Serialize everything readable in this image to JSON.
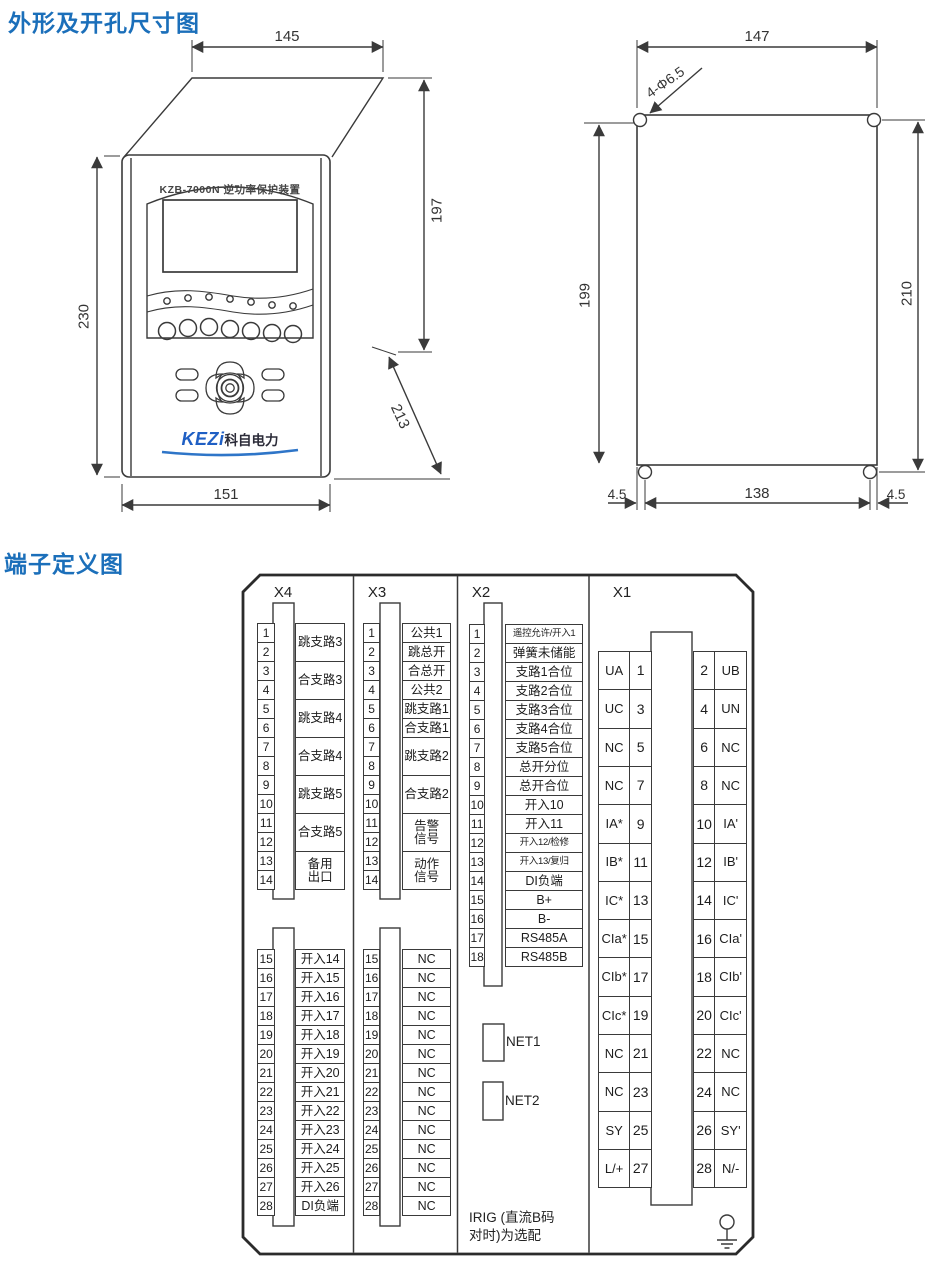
{
  "sections": {
    "outline_title": "外形及开孔尺寸图",
    "terminal_title": "端子定义图"
  },
  "front_view": {
    "device_title": "KZB-7000N 逆功率保护装置",
    "logo_main": "KEZi",
    "logo_sub": "科自电力",
    "dim_width_top": "145",
    "dim_height_rear": "197",
    "dim_height_front": "230",
    "dim_depth": "213",
    "dim_width_front": "151"
  },
  "cutout_view": {
    "dim_width_top": "147",
    "hole_label": "4-Φ6.5",
    "dim_height_left": "199",
    "dim_height_right": "210",
    "dim_margin_left": "4.5",
    "dim_hole_spacing": "138",
    "dim_margin_right": "4.5"
  },
  "terminal": {
    "x4": {
      "header": "X4",
      "top_first": 1,
      "top": [
        {
          "span": 2,
          "label": "跳支路3"
        },
        {
          "span": 2,
          "label": "合支路3"
        },
        {
          "span": 2,
          "label": "跳支路4"
        },
        {
          "span": 2,
          "label": "合支路4"
        },
        {
          "span": 2,
          "label": "跳支路5"
        },
        {
          "span": 2,
          "label": "合支路5"
        },
        {
          "span": 2,
          "label": "备用\n出口"
        }
      ],
      "bottom_first": 15,
      "bottom": [
        {
          "span": 1,
          "label": "开入14"
        },
        {
          "span": 1,
          "label": "开入15"
        },
        {
          "span": 1,
          "label": "开入16"
        },
        {
          "span": 1,
          "label": "开入17"
        },
        {
          "span": 1,
          "label": "开入18"
        },
        {
          "span": 1,
          "label": "开入19"
        },
        {
          "span": 1,
          "label": "开入20"
        },
        {
          "span": 1,
          "label": "开入21"
        },
        {
          "span": 1,
          "label": "开入22"
        },
        {
          "span": 1,
          "label": "开入23"
        },
        {
          "span": 1,
          "label": "开入24"
        },
        {
          "span": 1,
          "label": "开入25"
        },
        {
          "span": 1,
          "label": "开入26"
        },
        {
          "span": 1,
          "label": "DI负端"
        }
      ]
    },
    "x3": {
      "header": "X3",
      "top_first": 1,
      "top": [
        {
          "span": 1,
          "label": "公共1"
        },
        {
          "span": 1,
          "label": "跳总开"
        },
        {
          "span": 1,
          "label": "合总开"
        },
        {
          "span": 1,
          "label": "公共2"
        },
        {
          "span": 1,
          "label": "跳支路1"
        },
        {
          "span": 1,
          "label": "合支路1"
        },
        {
          "span": 2,
          "label": "跳支路2"
        },
        {
          "span": 2,
          "label": "合支路2"
        },
        {
          "span": 2,
          "label": "告警\n信号"
        },
        {
          "span": 2,
          "label": "动作\n信号"
        }
      ],
      "bottom_first": 15,
      "bottom": [
        {
          "span": 1,
          "label": "NC"
        },
        {
          "span": 1,
          "label": "NC"
        },
        {
          "span": 1,
          "label": "NC"
        },
        {
          "span": 1,
          "label": "NC"
        },
        {
          "span": 1,
          "label": "NC"
        },
        {
          "span": 1,
          "label": "NC"
        },
        {
          "span": 1,
          "label": "NC"
        },
        {
          "span": 1,
          "label": "NC"
        },
        {
          "span": 1,
          "label": "NC"
        },
        {
          "span": 1,
          "label": "NC"
        },
        {
          "span": 1,
          "label": "NC"
        },
        {
          "span": 1,
          "label": "NC"
        },
        {
          "span": 1,
          "label": "NC"
        },
        {
          "span": 1,
          "label": "NC"
        }
      ]
    },
    "x2": {
      "header": "X2",
      "top_first": 1,
      "top": [
        {
          "span": 1,
          "label": "遥控允许/开入1"
        },
        {
          "span": 1,
          "label": "弹簧未储能"
        },
        {
          "span": 1,
          "label": "支路1合位"
        },
        {
          "span": 1,
          "label": "支路2合位"
        },
        {
          "span": 1,
          "label": "支路3合位"
        },
        {
          "span": 1,
          "label": "支路4合位"
        },
        {
          "span": 1,
          "label": "支路5合位"
        },
        {
          "span": 1,
          "label": "总开分位"
        },
        {
          "span": 1,
          "label": "总开合位"
        },
        {
          "span": 1,
          "label": "开入10"
        },
        {
          "span": 1,
          "label": "开入11"
        },
        {
          "span": 1,
          "label": "开入12/检修"
        },
        {
          "span": 1,
          "label": "开入13/复归"
        },
        {
          "span": 1,
          "label": "DI负端"
        },
        {
          "span": 1,
          "label": "B+"
        },
        {
          "span": 1,
          "label": "B-"
        },
        {
          "span": 1,
          "label": "RS485A"
        },
        {
          "span": 1,
          "label": "RS485B"
        }
      ],
      "bottom": []
    },
    "x1": {
      "header": "X1",
      "rows": [
        [
          "UA",
          "1",
          "2",
          "UB"
        ],
        [
          "UC",
          "3",
          "4",
          "UN"
        ],
        [
          "NC",
          "5",
          "6",
          "NC"
        ],
        [
          "NC",
          "7",
          "8",
          "NC"
        ],
        [
          "IA*",
          "9",
          "10",
          "IA'"
        ],
        [
          "IB*",
          "11",
          "12",
          "IB'"
        ],
        [
          "IC*",
          "13",
          "14",
          "IC'"
        ],
        [
          "CIa*",
          "15",
          "16",
          "CIa'"
        ],
        [
          "CIb*",
          "17",
          "18",
          "CIb'"
        ],
        [
          "CIc*",
          "19",
          "20",
          "CIc'"
        ],
        [
          "NC",
          "21",
          "22",
          "NC"
        ],
        [
          "NC",
          "23",
          "24",
          "NC"
        ],
        [
          "SY",
          "25",
          "26",
          "SY'"
        ],
        [
          "L/+",
          "27",
          "28",
          "N/-"
        ]
      ]
    },
    "net1_label": "NET1",
    "net2_label": "NET2",
    "irig_note": "IRIG (直流B码\n对时)为选配"
  },
  "colors": {
    "title_blue": "#1b6fba",
    "logo_blue": "#1f5fc4",
    "line_gray": "#3a3a3a"
  }
}
